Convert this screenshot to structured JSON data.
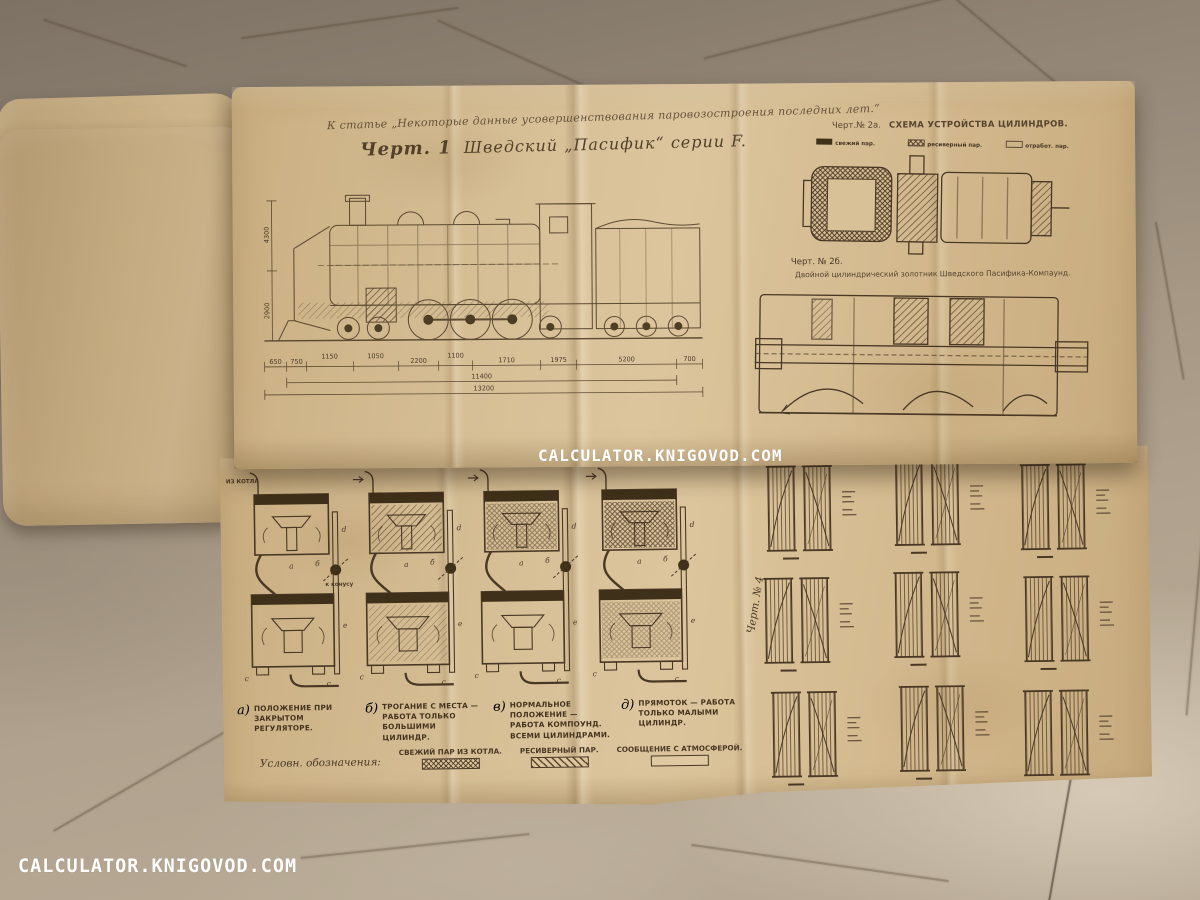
{
  "watermark": {
    "center": "CALCULATOR.KNIGOVOD.COM",
    "bottom_left": "CALCULATOR.KNIGOVOD.COM"
  },
  "sheet_top": {
    "handwritten_note": "К статье „Некоторые данные усовершенствования паровозостроения последних лет.“",
    "fig1": {
      "number": "Черт. 1",
      "title": "Шведский „Пасифик“ серии F.",
      "dims_row": [
        "650",
        "750",
        "1150",
        "1050",
        "2200",
        "1100",
        "1710",
        "1975",
        "5200",
        "700"
      ],
      "dim_total1": "11400",
      "dim_total2": "13200",
      "dim_height1": "4300",
      "dim_height2": "2900"
    },
    "fig2a": {
      "label": "Черт.№ 2а.",
      "title": "Схема устройства цилиндров.",
      "legend": [
        "свежий пар.",
        "ресиверный пар.",
        "отработ. пар."
      ]
    },
    "fig2b": {
      "label": "Черт. № 2б.",
      "caption": "Двойной цилиндрический золотник Шведского Пасифика-Компаунд."
    }
  },
  "sheet_bottom": {
    "fig3": {
      "title": "Черт.3а-д.  СХЕМА ДЕЙСТВИЯ БАЙПАССА ФЛОДИНА.",
      "inlet_label": "ИЗ КОТЛА",
      "cone_label": "к конусу",
      "part_letters": {
        "a": "a",
        "b": "б",
        "c": "c",
        "c2": "c",
        "d": "d",
        "e": "e"
      },
      "captions": [
        {
          "letter": "а)",
          "text": "Положение при закрытом регуляторе."
        },
        {
          "letter": "б)",
          "text": "Трогание с места — работа только большими цилиндр."
        },
        {
          "letter": "в)",
          "text": "Нормальное положение — работа Компоунд. всеми цилиндрами."
        },
        {
          "letter": "д)",
          "text": "Прямоток — работа только малыми цилиндр."
        }
      ],
      "legend_title": "Условн. обозначения:",
      "legend": [
        {
          "label": "Свежий пар из котла.",
          "swatch": "cross"
        },
        {
          "label": "Ресиверный пар.",
          "swatch": "diagonal"
        },
        {
          "label": "Сообщение с атмосферой.",
          "swatch": "empty"
        }
      ]
    },
    "fig4": {
      "label": "Черт. № 4"
    }
  }
}
